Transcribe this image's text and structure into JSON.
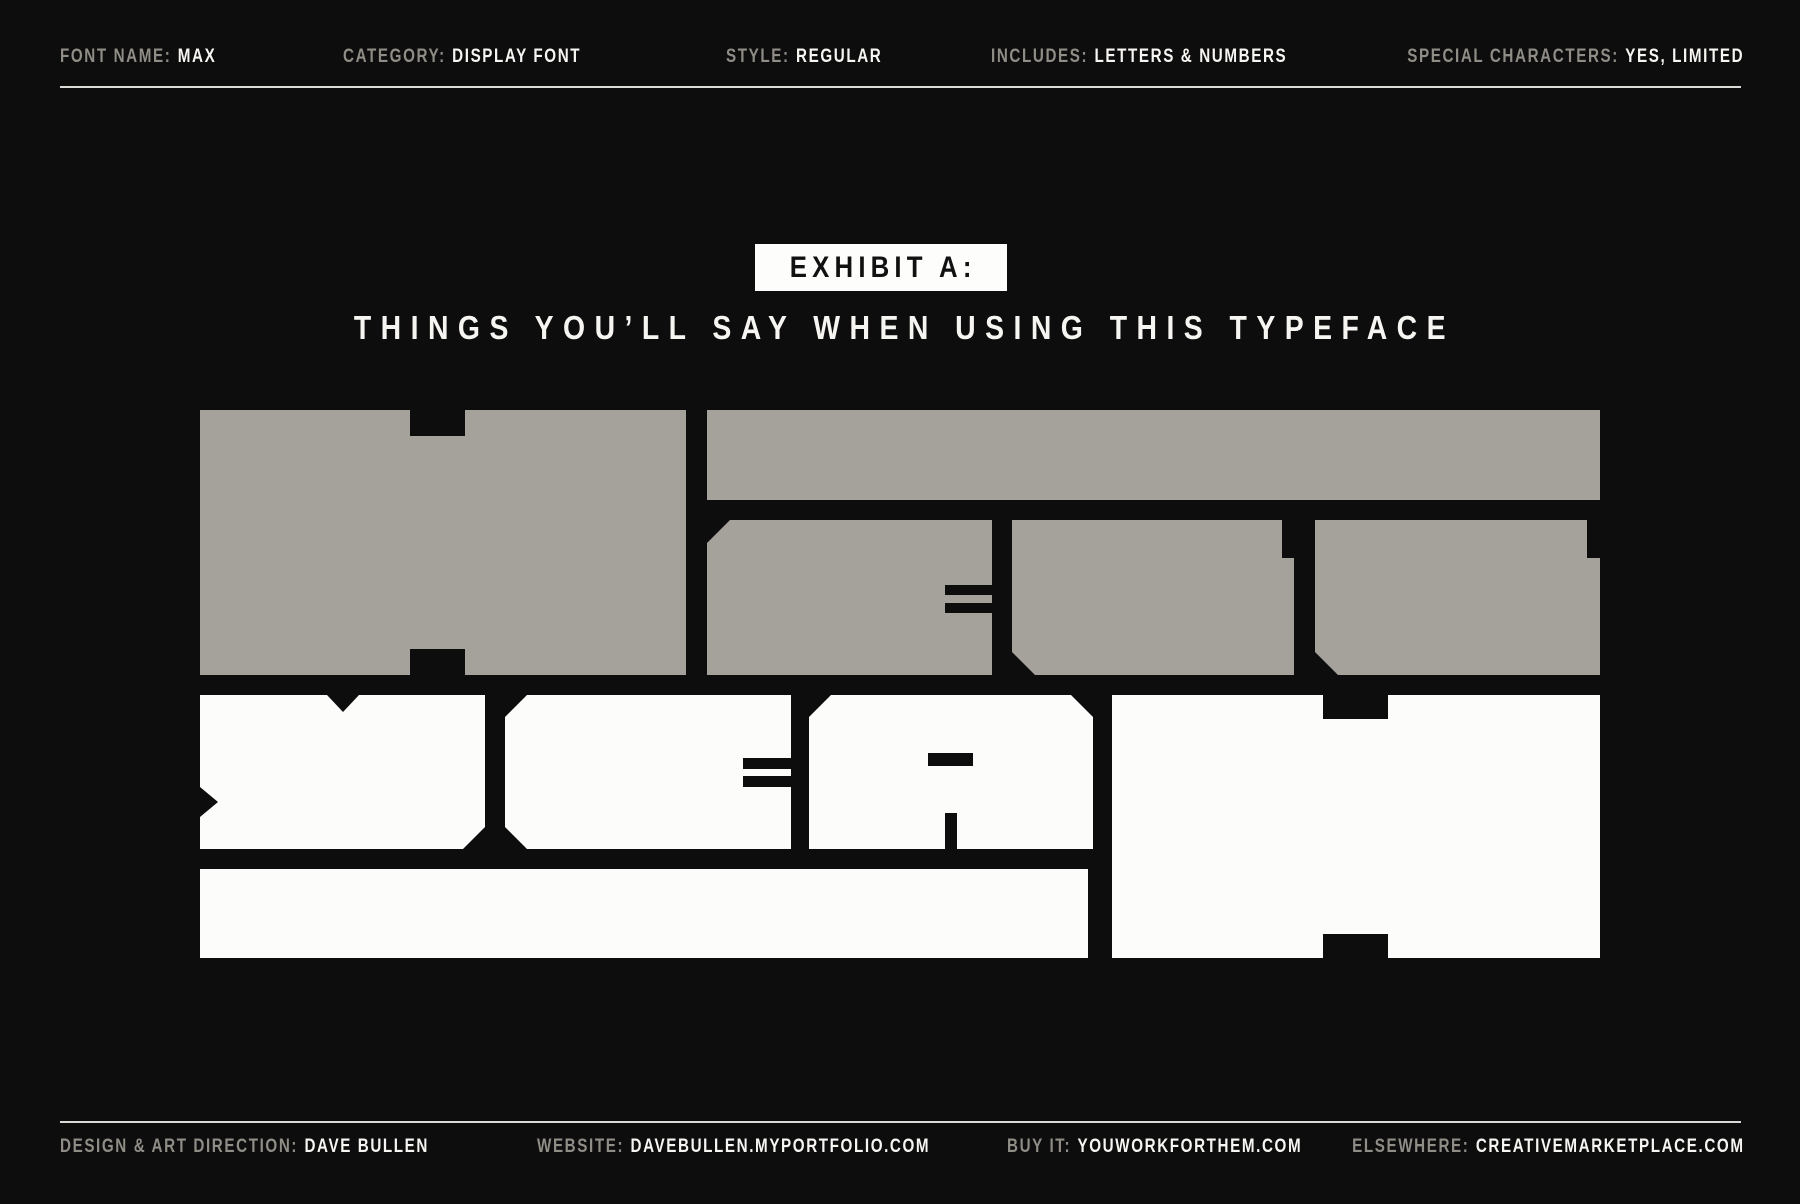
{
  "colors": {
    "background": "#0e0d0d",
    "ink_gray": "#a5a29b",
    "ink_white": "#fcfcfb",
    "text_muted": "#8f8d86",
    "text_bright": "#f6f5f2",
    "rule": "#dadad7",
    "badge_bg": "#fdfdfc",
    "badge_text": "#121111"
  },
  "header": {
    "items": [
      {
        "label": "FONT NAME:",
        "value": "MAX"
      },
      {
        "label": "CATEGORY:",
        "value": "DISPLAY FONT"
      },
      {
        "label": "STYLE:",
        "value": "REGULAR"
      },
      {
        "label": "INCLUDES:",
        "value": "LETTERS & NUMBERS"
      },
      {
        "label": "SPECIAL CHARACTERS:",
        "value": "YES, LIMITED"
      }
    ]
  },
  "exhibit": {
    "badge": "EXHIBIT A:",
    "subtitle": "THINGS YOU’LL SAY WHEN USING THIS TYPEFACE"
  },
  "specimen": {
    "word_top": "HECK",
    "word_bottom": "YEAH"
  },
  "footer": {
    "items": [
      {
        "label": "DESIGN & ART DIRECTION:",
        "value": "DAVE BULLEN"
      },
      {
        "label": "WEBSITE:",
        "value": "DAVEBULLEN.MYPORTFOLIO.COM"
      },
      {
        "label": "BUY IT:",
        "value": "YOUWORKFORTHEM.COM"
      },
      {
        "label": "ELSEWHERE:",
        "value": "CREATIVEMARKETPLACE.COM"
      }
    ]
  }
}
